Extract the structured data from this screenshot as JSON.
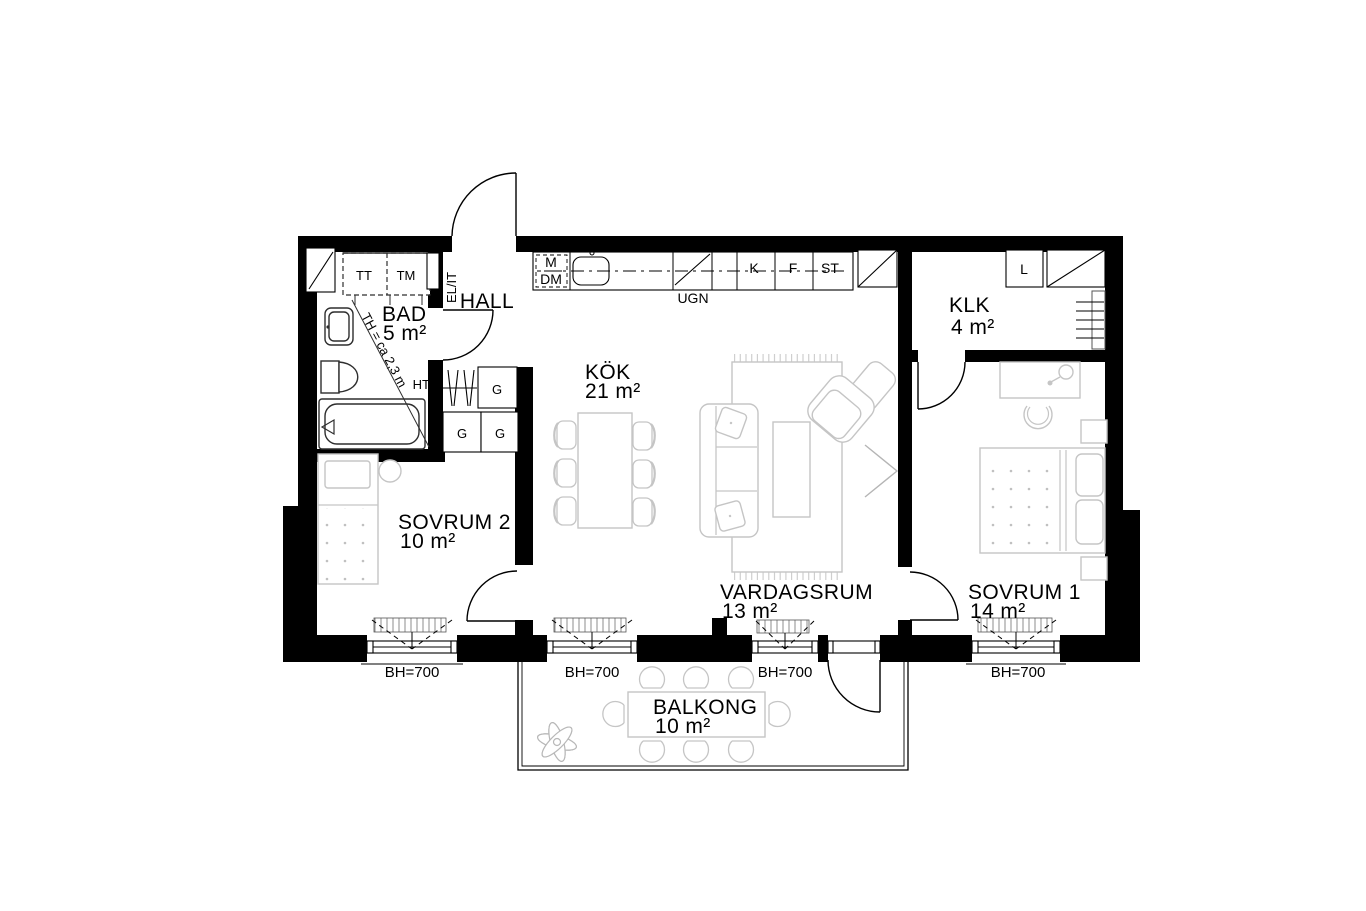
{
  "floor_plan": {
    "rooms": [
      {
        "id": "bad",
        "name": "BAD",
        "area": "5 m²"
      },
      {
        "id": "hall",
        "name": "HALL",
        "area": ""
      },
      {
        "id": "kok",
        "name": "KÖK",
        "area": "21 m²"
      },
      {
        "id": "klk",
        "name": "KLK",
        "area": "4 m²"
      },
      {
        "id": "sovrum2",
        "name": "SOVRUM 2",
        "area": "10 m²"
      },
      {
        "id": "vardagsrum",
        "name": "VARDAGSRUM",
        "area": "13 m²"
      },
      {
        "id": "sovrum1",
        "name": "SOVRUM 1",
        "area": "14 m²"
      },
      {
        "id": "balkong",
        "name": "BALKONG",
        "area": "10 m²"
      }
    ],
    "appliances": {
      "dryer": "TT",
      "washer": "TM",
      "electrical_panel": "EL/IT",
      "microwave": "M",
      "dishwasher": "DM",
      "oven": "UGN",
      "fridge": "K",
      "freezer": "F",
      "cleaning_cabinet": "ST",
      "linen_cabinet": "L",
      "wardrobe": "G",
      "towel_warmer": "HT"
    },
    "annotations": {
      "ceiling_height": "TH = ca 2,3 m",
      "window_sill_height": "BH=700"
    },
    "colors": {
      "walls": "#000000",
      "furniture": "#c5c5c5",
      "fixtures": "#2e2e2e"
    }
  }
}
